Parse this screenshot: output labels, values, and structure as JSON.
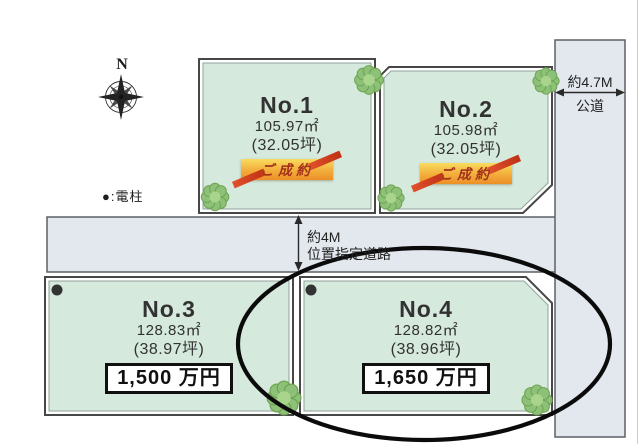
{
  "compass": {
    "label": "N"
  },
  "legend": {
    "electric_pole": "●:電柱"
  },
  "roads": {
    "public": {
      "width": "約4.7M",
      "name": "公道"
    },
    "designated": {
      "width": "約4M",
      "name": "位置指定道路"
    }
  },
  "lots": [
    {
      "no": "No.1",
      "area": "105.97㎡",
      "tsubo": "(32.05坪)",
      "status": "ご成約"
    },
    {
      "no": "No.2",
      "area": "105.98㎡",
      "tsubo": "(32.05坪)",
      "status": "ご成約"
    },
    {
      "no": "No.3",
      "area": "128.83㎡",
      "tsubo": "(38.97坪)",
      "price": "1,500 万円"
    },
    {
      "no": "No.4",
      "area": "128.82㎡",
      "tsubo": "(38.96坪)",
      "price": "1,650 万円"
    }
  ],
  "colors": {
    "lot_fill": "#d5e9dd",
    "road_fill": "#e3e8ee",
    "outline": "#474747",
    "inner_line": "#8fa29a",
    "highlight_ellipse": "#000000",
    "banner_gold": "#f3b13e",
    "banner_text": "#a5301c"
  }
}
